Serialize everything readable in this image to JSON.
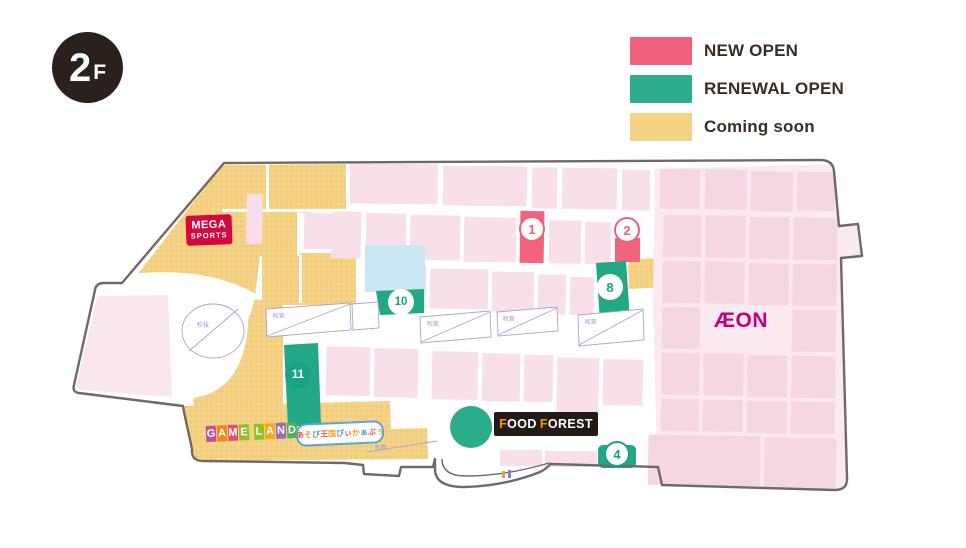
{
  "floor_badge": {
    "number": "2",
    "suffix": "F"
  },
  "legend": {
    "items": [
      {
        "label": "NEW OPEN",
        "color": "#F0607C"
      },
      {
        "label": "RENEWAL OPEN",
        "color": "#2EAC8B"
      },
      {
        "label": "Coming soon",
        "color": "#F3D284"
      }
    ]
  },
  "map": {
    "colors": {
      "new_open_shop": "#F2637C",
      "renewal_shop": "#23A885",
      "coming_soon_area": "#F4D183",
      "shop_block_pink": "#F8DFE9",
      "floor_background_pink": "#FBE9F1",
      "outline_gray": "#6E6A68",
      "water_blue": "#C9E6F2",
      "aeon_magenta": "#C0007E",
      "mega_sports_red": "#D5073F",
      "food_forest_black": "#221B15",
      "food_forest_orange": "#F39800"
    },
    "markers": [
      {
        "number": "1",
        "type": "new-open"
      },
      {
        "number": "2",
        "type": "new-open"
      },
      {
        "number": "8",
        "type": "renewal"
      },
      {
        "number": "10",
        "type": "renewal"
      },
      {
        "number": "11",
        "type": "renewal-filled"
      },
      {
        "number": "4",
        "type": "renewal-outline"
      }
    ],
    "tenants": {
      "mega_sports": {
        "line1": "MEGA",
        "line2": "SPORTS"
      },
      "aeon": "ÆON",
      "food_forest": {
        "f1": "F",
        "p1": "OOD",
        "f2": "F",
        "p2": "OREST"
      },
      "game_land": {
        "letters": [
          {
            "ch": "G",
            "color": "#C0509E"
          },
          {
            "ch": "A",
            "color": "#F08519"
          },
          {
            "ch": "M",
            "color": "#E2506B"
          },
          {
            "ch": "E",
            "color": "#8FBF21"
          },
          {
            "ch": "L",
            "color": "#8FC31F"
          },
          {
            "ch": "A",
            "color": "#F5A623"
          },
          {
            "ch": "N",
            "color": "#9B6BB3"
          },
          {
            "ch": "D",
            "color": "#49B552"
          }
        ]
      },
      "asobi": {
        "chars": [
          {
            "ch": "あ"
          },
          {
            "ch": "そ"
          },
          {
            "ch": "び"
          },
          {
            "ch": "王"
          },
          {
            "ch": "国"
          },
          {
            "ch": "ぴ"
          },
          {
            "ch": "ぃ"
          },
          {
            "ch": "か"
          },
          {
            "ch": "ぁ"
          },
          {
            "ch": "ぶ"
          },
          {
            "ch": "ぅ"
          }
        ]
      }
    },
    "annotations": {
      "void_label": "吹抜"
    }
  }
}
